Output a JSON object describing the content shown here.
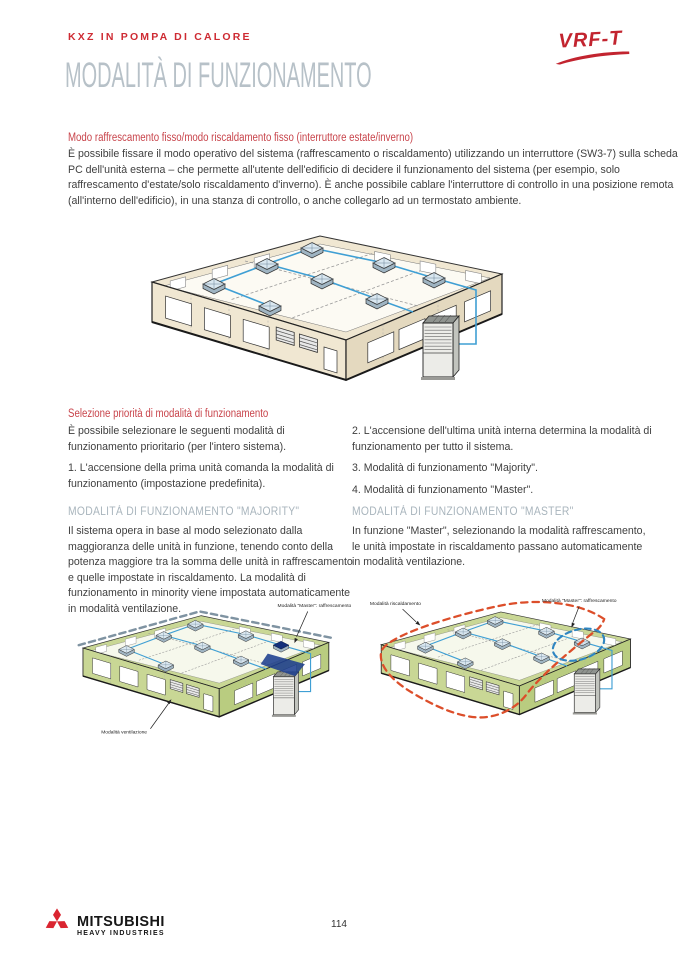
{
  "page": {
    "eyebrow": "KXZ IN POMPA DI CALORE",
    "title": "MODALITÀ DI FUNZIONAMENTO",
    "page_number": "114"
  },
  "logo": {
    "brand": "VRF-T"
  },
  "footer": {
    "brand_line1": "MITSUBISHI",
    "brand_line2": "HEAVY INDUSTRIES"
  },
  "section_fixed_mode": {
    "heading": "Modo raffrescamento fisso/modo riscaldamento fisso (interruttore estate/inverno)",
    "body": "È possibile fissare il modo operativo del sistema (raffrescamento o riscaldamento) utilizzando un interruttore (SW3-7) sulla scheda PC dell'unità esterna – che permette all'utente dell'edificio di decidere il funzionamento del sistema (per esempio, solo raffrescamento d'estate/solo riscaldamento d'inverno). È anche possibile cablare l'interruttore di controllo in una posizione remota (all'interno dell'edificio), in una stanza di controllo, o anche collegarlo ad un termostato ambiente."
  },
  "section_priority": {
    "heading": "Selezione priorità di modalità di funzionamento",
    "intro": "È possibile selezionare le seguenti modalità di funzionamento prioritario (per l'intero sistema).",
    "item1": "1. L'accensione della prima unità comanda la modalità di funzionamento (impostazione predefinita).",
    "item2": "2. L'accensione dell'ultima unità interna determina la modalità di funzionamento per tutto il sistema.",
    "item3": "3. Modalità di funzionamento \"Majority\".",
    "item4": "4. Modalità di funzionamento \"Master\"."
  },
  "section_majority": {
    "heading": "MODALITÀ DI FUNZIONAMENTO \"MAJORITY\"",
    "body": "Il sistema opera in base al modo selezionato dalla maggioranza delle unità in funzione, tenendo conto della potenza maggiore tra la somma delle unità in raffrescamento e quelle impostate in riscaldamento. La modalità di funzionamento in minority viene impostata automaticamente in modalità ventilazione."
  },
  "section_master": {
    "heading": "MODALITÀ DI FUNZIONAMENTO \"MASTER\"",
    "body": "In funzione \"Master\", selezionando la modalità raffrescamento, le unità impostate in riscaldamento passano automaticamente in modalità ventilazione."
  },
  "diagram_left": {
    "label_master": "Modalità \"Master\": raffrescamento",
    "label_ventilation": "Modalità ventilazione"
  },
  "diagram_right": {
    "label_heating": "Modalità riscaldamento",
    "label_master": "Modalità \"Master\": raffrescamento"
  },
  "colors": {
    "accent_red": "#c8444b",
    "heading_gray": "#a9b5bd",
    "pipe_blue": "#3f9fd4",
    "wall_cream": "#f0e7d2",
    "wall_green": "#c9d795",
    "dashed_red": "#dc4e2a",
    "dashed_blue": "#2f86c2"
  }
}
